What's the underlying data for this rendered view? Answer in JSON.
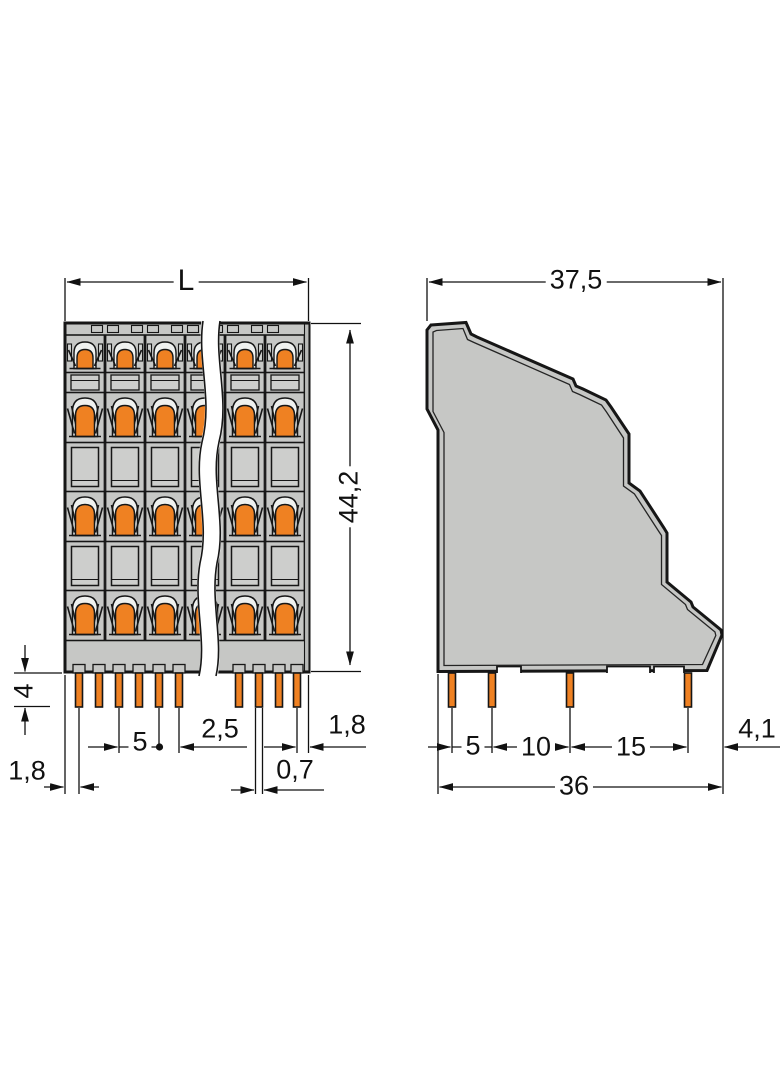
{
  "front_view": {
    "length_label": "L",
    "height_label": "44,2",
    "pin_length_label": "4",
    "edge_to_pin_left_label": "1,8",
    "pitch_label": "5",
    "pin_pair_spacing_label": "2,5",
    "pin_width_label": "0,7",
    "edge_to_pin_right_label": "1,8"
  },
  "side_view": {
    "depth_label": "37,5",
    "pin_spacing_labels": [
      "5",
      "10",
      "15"
    ],
    "pin_to_edge_label": "4,1",
    "overall_depth_label": "36"
  },
  "colors": {
    "body_gray": "#c6c7c5",
    "accent_orange": "#ef8122",
    "outline": "#161616",
    "background": "#ffffff"
  }
}
